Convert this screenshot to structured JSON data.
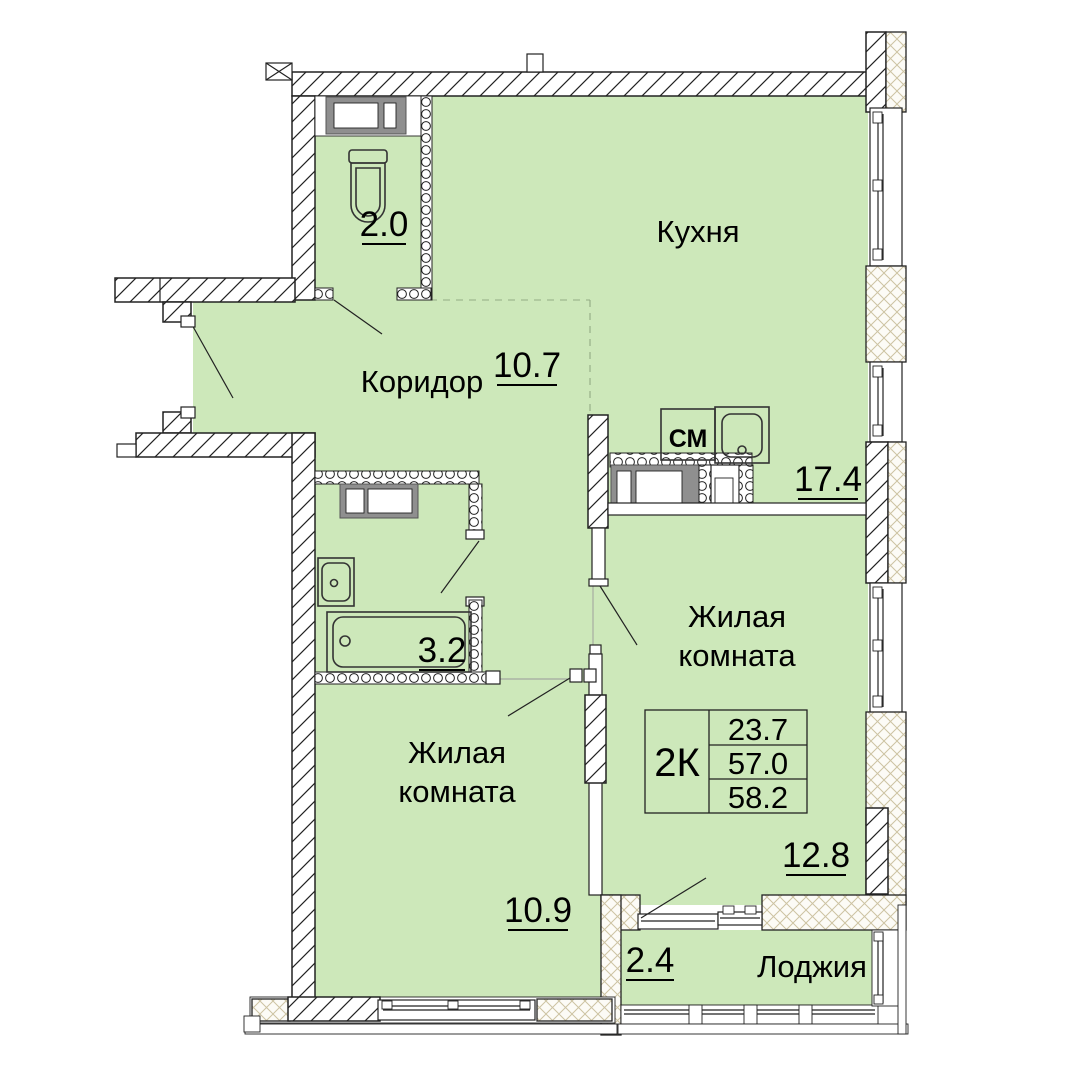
{
  "plan": {
    "colors": {
      "room_fill": "#cde8ba",
      "hatch_tan": "#cdc3a2",
      "frame_grey": "#8f8f8f",
      "line": "#222222"
    },
    "rooms": {
      "toilet": {
        "area": "2.0"
      },
      "kitchen": {
        "name": "Кухня",
        "area": "17.4"
      },
      "corridor": {
        "name": "Коридор",
        "area": "10.7"
      },
      "bathroom": {
        "area": "3.2"
      },
      "living_right": {
        "name_line1": "Жилая",
        "name_line2": "комната",
        "area": "12.8"
      },
      "living_left": {
        "name_line1": "Жилая",
        "name_line2": "комната",
        "area": "10.9"
      },
      "loggia": {
        "name": "Лоджия",
        "area": "2.4"
      }
    },
    "fixtures": {
      "washing_machine": "СМ"
    },
    "summary": {
      "unit_type": "2К",
      "rows": [
        "23.7",
        "57.0",
        "58.2"
      ]
    }
  }
}
